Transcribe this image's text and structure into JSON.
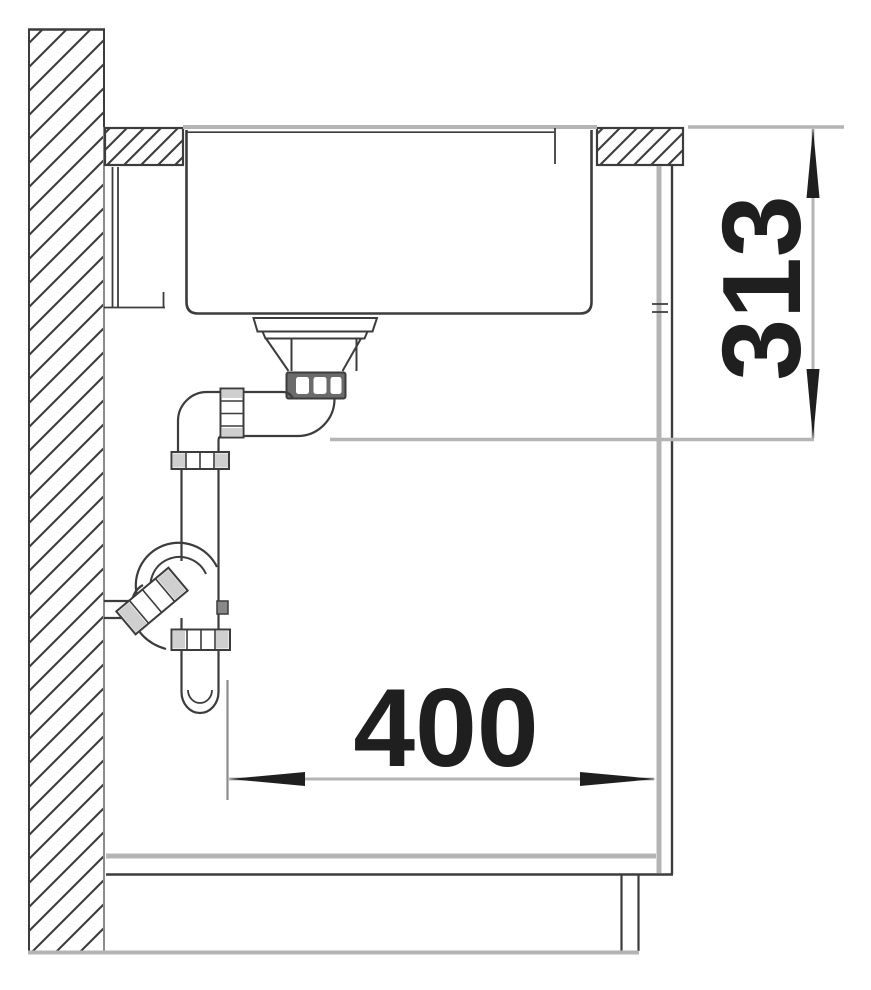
{
  "title": "Sink installation side-section drawing",
  "dimensions": {
    "height": {
      "value": "313",
      "orientation": "vertical",
      "arrow_top": "up",
      "arrow_bottom": "down"
    },
    "width": {
      "value": "400",
      "orientation": "horizontal",
      "arrow_left": "left",
      "arrow_right": "right"
    }
  },
  "parts": [
    "wall-hatched",
    "countertop-left-section",
    "countertop-right-section",
    "sink-bowl",
    "drain-strainer",
    "drain-tailpipe-elbow",
    "siphon-trap",
    "wall-outlet-stub",
    "cabinet-side-panel",
    "cabinet-bottom-panel",
    "cabinet-plinth",
    "floor-line",
    "back-rail"
  ],
  "colors": {
    "background": "#ffffff",
    "line-dark": "#3c3c3c",
    "line-gray": "#b4b4b4",
    "line-mid": "#8c8c8c",
    "fill-shade": "#cfcfcf",
    "nut-dark": "#6b6b6b",
    "text": "#1f1f1f"
  }
}
